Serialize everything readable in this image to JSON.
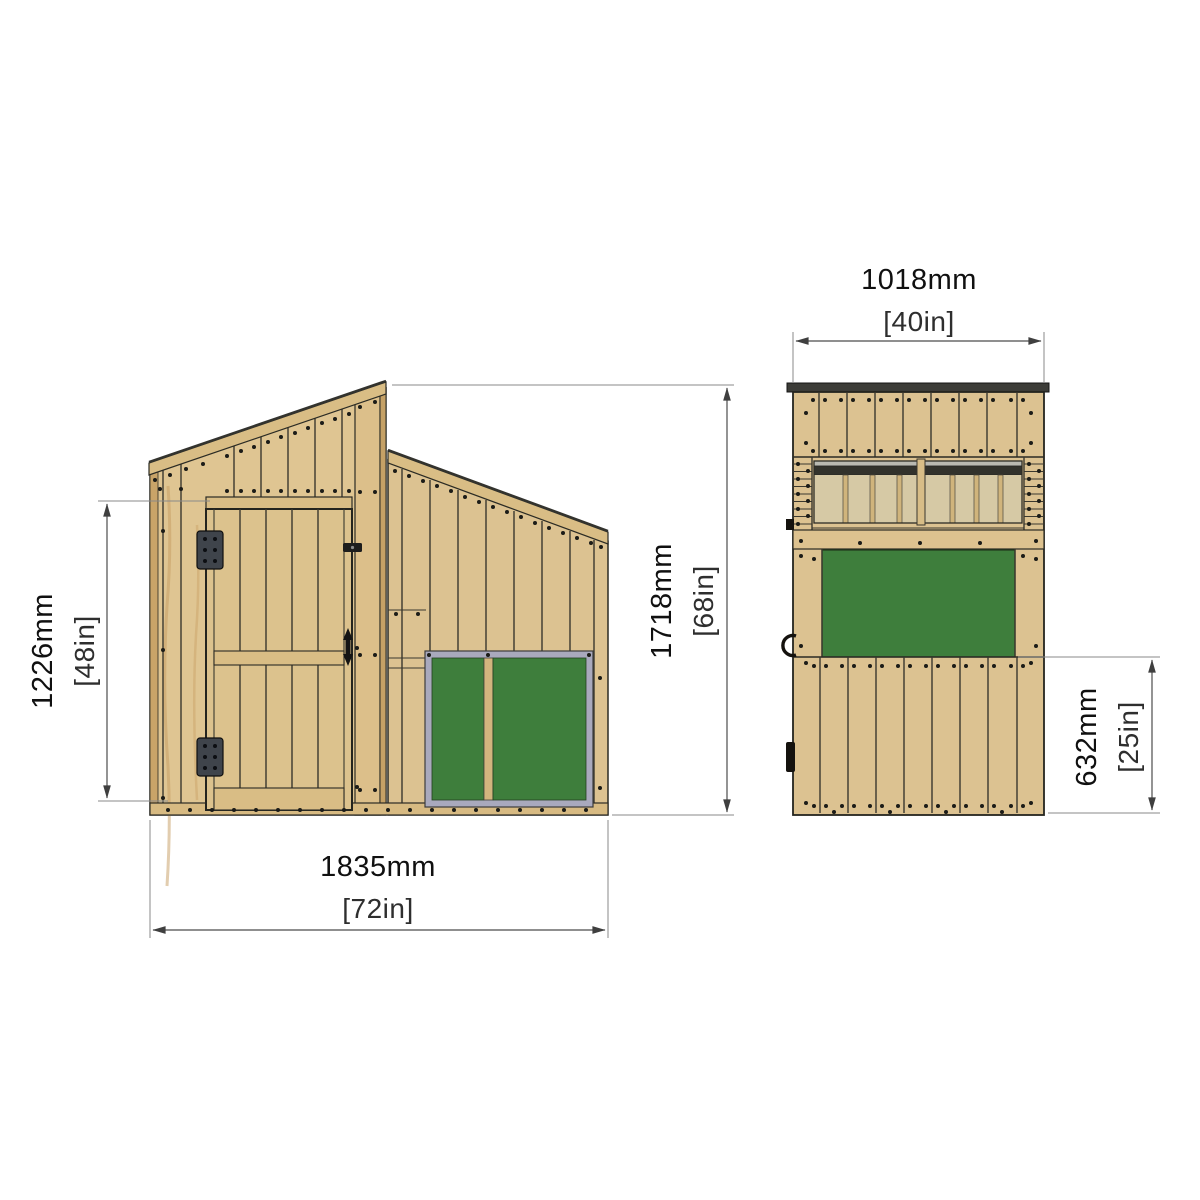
{
  "diagram": {
    "title": "Wooden shed / playhouse elevation drawing",
    "type": "technical-elevation-drawing",
    "colors": {
      "wood": "#dcc291",
      "wood_band": "#d9bd85",
      "wood_edge": "#c9a468",
      "board_green": "#3e7e3c",
      "window_frame_gray": "#a9a9bd",
      "roof_dark": "#3c3c38",
      "outline": "#2b2b24",
      "dimension_line": "#4c4c4c",
      "text": "#101010",
      "background": "#ffffff"
    },
    "views": {
      "side": {
        "name": "side elevation with door",
        "dimensions": {
          "door_height": {
            "mm": "1226mm",
            "inches": "[48in]"
          },
          "overall_height": {
            "mm": "1718mm",
            "inches": "[68in]"
          },
          "overall_depth": {
            "mm": "1835mm",
            "inches": "[72in]"
          }
        }
      },
      "front": {
        "name": "front elevation with window and green board",
        "dimensions": {
          "overall_width": {
            "mm": "1018mm",
            "inches": "[40in]"
          },
          "lower_cladding_height": {
            "mm": "632mm",
            "inches": "[25in]"
          }
        }
      }
    }
  }
}
